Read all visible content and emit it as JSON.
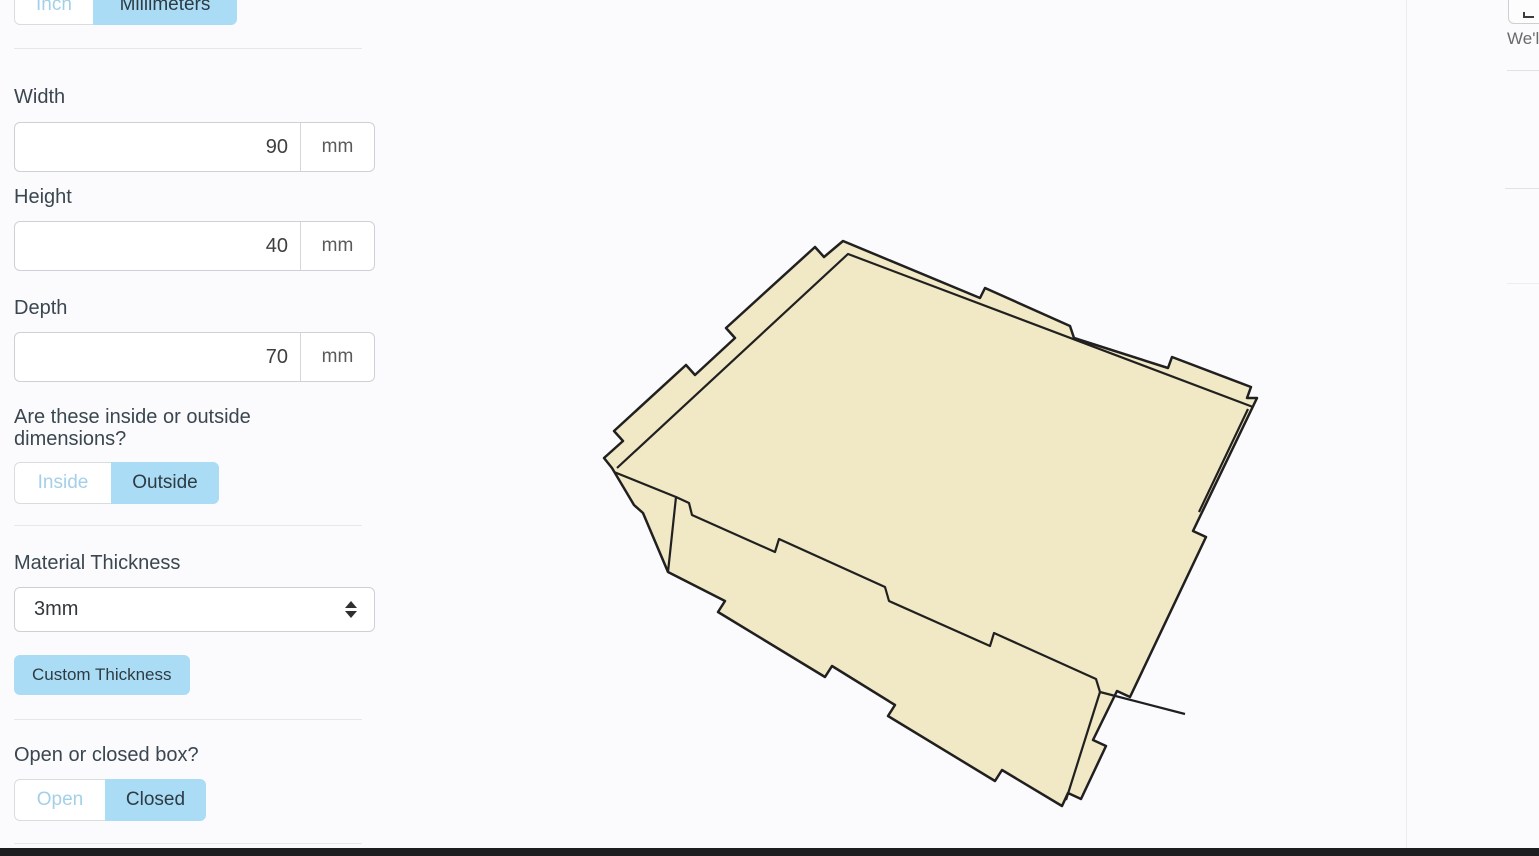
{
  "unit_toggle": {
    "options": [
      "Inch",
      "Millimeters"
    ],
    "active": "Millimeters"
  },
  "dimensions": {
    "width": {
      "label": "Width",
      "value": "90",
      "unit": "mm"
    },
    "height": {
      "label": "Height",
      "value": "40",
      "unit": "mm"
    },
    "depth": {
      "label": "Depth",
      "value": "70",
      "unit": "mm"
    }
  },
  "inside_outside": {
    "question": "Are these inside or outside dimensions?",
    "options": [
      "Inside",
      "Outside"
    ],
    "active": "Outside"
  },
  "material": {
    "label": "Material Thickness",
    "selected": "3mm"
  },
  "buttons": {
    "custom_thickness": "Custom Thickness"
  },
  "open_closed": {
    "question": "Open or closed box?",
    "options": [
      "Open",
      "Closed"
    ],
    "active": "Closed"
  },
  "right_panel": {
    "partial_text": "We'l"
  },
  "colors": {
    "accent_blue": "#aadcf5",
    "inactive_toggle_text": "#a4cfe9",
    "box_fill": "#f1e8c5",
    "box_stroke": "#202020",
    "bottom_bar": "#1d1e1f"
  },
  "box_render": {
    "fill": "#f1e8c5",
    "stroke": "#202020",
    "silhouette": "M 604 458 L 623 441 L 614 431 L 686 365 L 695 375 L 735 338 L 726 328 L 815 247 L 824 257 L 843 241 L 980 298 L 985 288 L 1070 326 L 1074 338 L 1168 368 L 1172 357 L 1251 387 L 1247 398 L 1257 398 L 1193 531 L 1206 537 L 1130 697 L 1117 691 L 1093 740 L 1106 746 L 1081 799 L 1068 793 L 1062 806 L 1002 770 L 995 781 L 888 716 L 895 705 L 832 666 L 825 677 L 718 612 L 725 601 L 668 572 L 643 513 L 634 505 L 612 468 Z",
    "inner_lines": "M 617 468 L 848 254 L 1253 407 M 614 472 L 676 497 L 668 572 M 676 497 L 689 503 L 692 515 L 775 552 L 779 539 L 885 587 L 889 601 L 990 646 L 994 633 L 1096 679 L 1100 692 L 1185 714 M 1100 692 L 1066 800 M 1248 409 L 1199 512"
  }
}
